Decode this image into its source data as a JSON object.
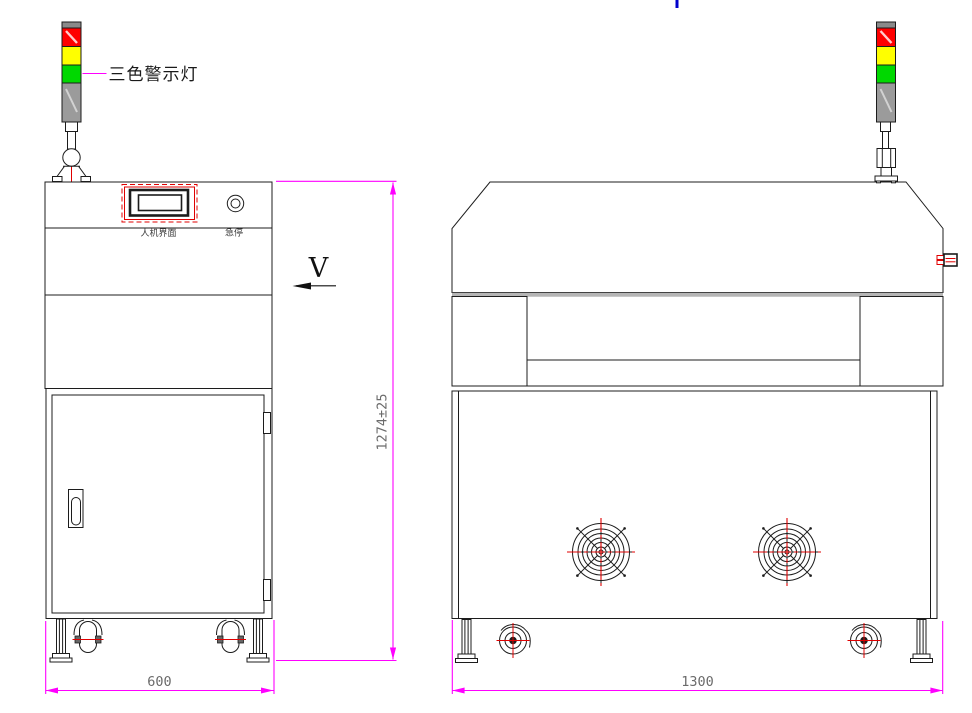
{
  "drawing": {
    "labels": {
      "tower": "三色警示灯",
      "hmi": "人机界面",
      "estop": "急停",
      "view_direction": "V"
    },
    "dimensions": {
      "overall_height": "1274±25",
      "side_width": "600",
      "front_width": "1300"
    },
    "colors": {
      "dimension_line": "#FF00FF",
      "lamp_red": "#FF0000",
      "lamp_yellow": "#FFFF00",
      "lamp_green": "#00D800",
      "lamp_body_gray": "#9B9B9B",
      "centerline_red": "#E00000",
      "outline_black": "#1C1C1C",
      "hood_edge_gray": "#B5B5B5",
      "annotation_blue": "#0000CC"
    }
  }
}
